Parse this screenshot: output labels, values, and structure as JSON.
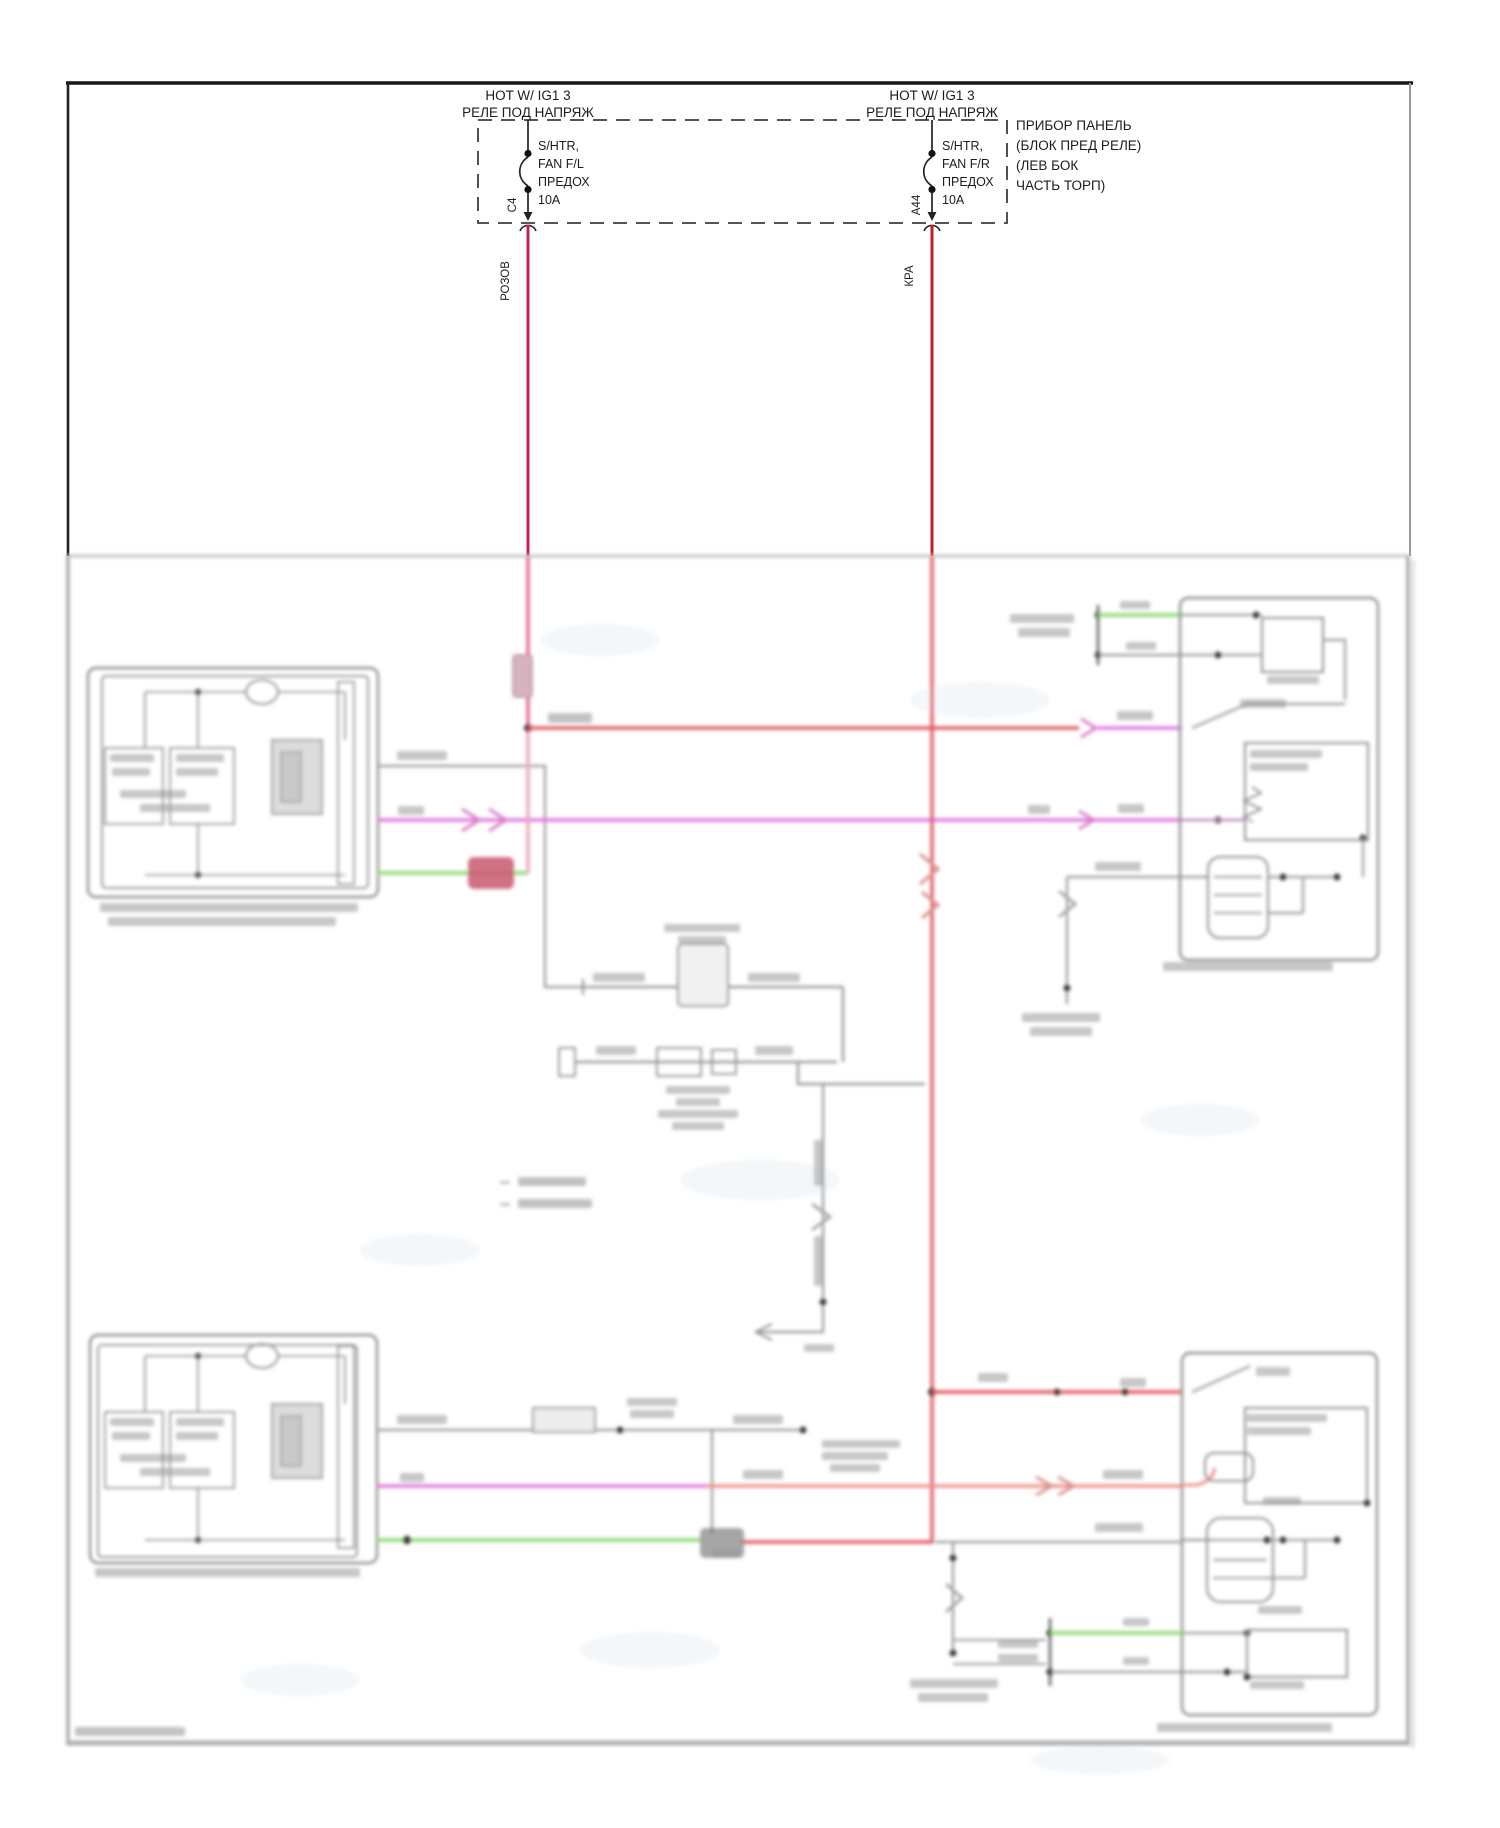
{
  "diagram": {
    "kind": "automotive seat-heater wiring diagram (lower half of scan is out of focus / illegible)",
    "power_rail": {
      "left_fuse": {
        "title_line1": "HOT W/ IG1 3",
        "title_line2": "РЕЛЕ ПОД НАПРЯЖ",
        "fuse_line1": "S/HTR,",
        "fuse_line2": "FAN F/L",
        "fuse_line3": "ПРЕДОХ",
        "fuse_line4": "10A",
        "connector_pin": "C4",
        "wire_color_label": "РОЗОВ"
      },
      "right_fuse": {
        "title_line1": "HOT W/ IG1 3",
        "title_line2": "РЕЛЕ ПОД НАПРЯЖ",
        "fuse_line1": "S/HTR,",
        "fuse_line2": "FAN F/R",
        "fuse_line3": "ПРЕДОХ",
        "fuse_line4": "10A",
        "connector_pin": "A44",
        "wire_color_label": "КРА"
      },
      "panel_note_lines": [
        "ПРИБОР ПАНЕЛЬ",
        "(БЛОК ПРЕД РЕЛЕ)",
        "(ЛЕВ БОК",
        "ЧАСТЬ ТОРП)"
      ]
    },
    "colors": {
      "crisp_pink_wire": "#c21f5e",
      "crisp_red_wire": "#c22026",
      "blur_red_wire": "#e25a5e",
      "blur_pink_wire": "#eba6bb",
      "blur_magenta_wire": "#df7ade",
      "blur_salmon_wire": "#ef938c",
      "blur_green_wire": "#97dd82",
      "blur_gray_wire": "#969696",
      "frame_black": "#1a1a1a"
    }
  }
}
